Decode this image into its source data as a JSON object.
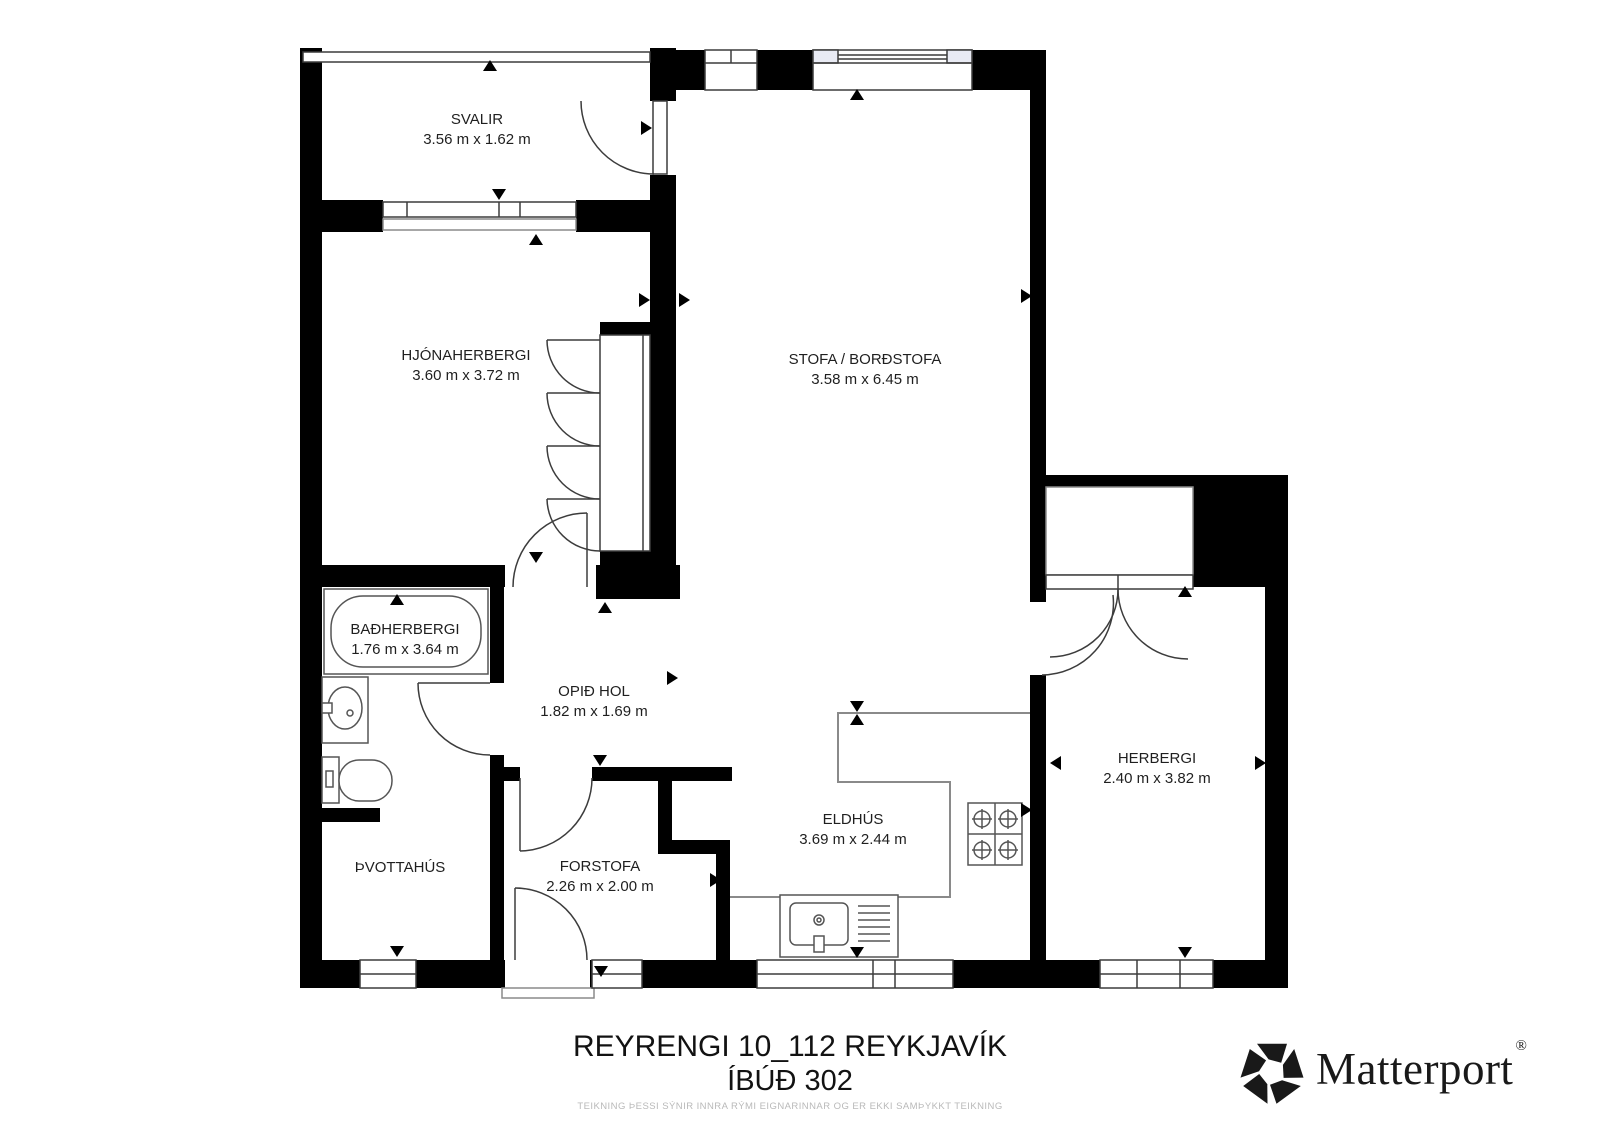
{
  "rooms": {
    "svalir": {
      "name": "SVALIR",
      "dims": "3.56 m x 1.62 m"
    },
    "hjonaherbergi": {
      "name": "HJÓNAHERBERGI",
      "dims": "3.60 m x 3.72 m"
    },
    "stofa": {
      "name": "STOFA / BORÐSTOFA",
      "dims": "3.58 m x 6.45 m"
    },
    "badherbergi": {
      "name": "BAÐHERBERGI",
      "dims": "1.76 m x 3.64 m"
    },
    "opid_hol": {
      "name": "OPIÐ HOL",
      "dims": "1.82 m x 1.69 m"
    },
    "thvottahus": {
      "name": "ÞVOTTAHÚS",
      "dims": ""
    },
    "forstofa": {
      "name": "FORSTOFA",
      "dims": "2.26 m x 2.00 m"
    },
    "eldhus": {
      "name": "ELDHÚS",
      "dims": "3.69 m x 2.44 m"
    },
    "herbergi": {
      "name": "HERBERGI",
      "dims": "2.40 m x 3.82 m"
    }
  },
  "footer": {
    "title_line1": "REYRENGI 10_112 REYKJAVÍK",
    "title_line2": "ÍBÚÐ 302",
    "disclaimer": "TEIKNING ÞESSI SÝNIR INNRA RÝMI EIGNARINNAR OG ER EKKI SAMÞYKKT TEIKNING"
  },
  "branding": {
    "logo_text": "Matterport",
    "registered_mark": "®"
  },
  "fixtures": [
    "bathtub",
    "bathroom-sink",
    "toilet",
    "wardrobe",
    "closet",
    "stove",
    "kitchen-sink"
  ],
  "colors": {
    "wall": "#000000",
    "line": "#3c3c3c",
    "light_line": "#8a8a8a",
    "text": "#1f1f1f",
    "disclaimer_text": "#b9b9b9",
    "window_pane": "#e9ebf4"
  }
}
